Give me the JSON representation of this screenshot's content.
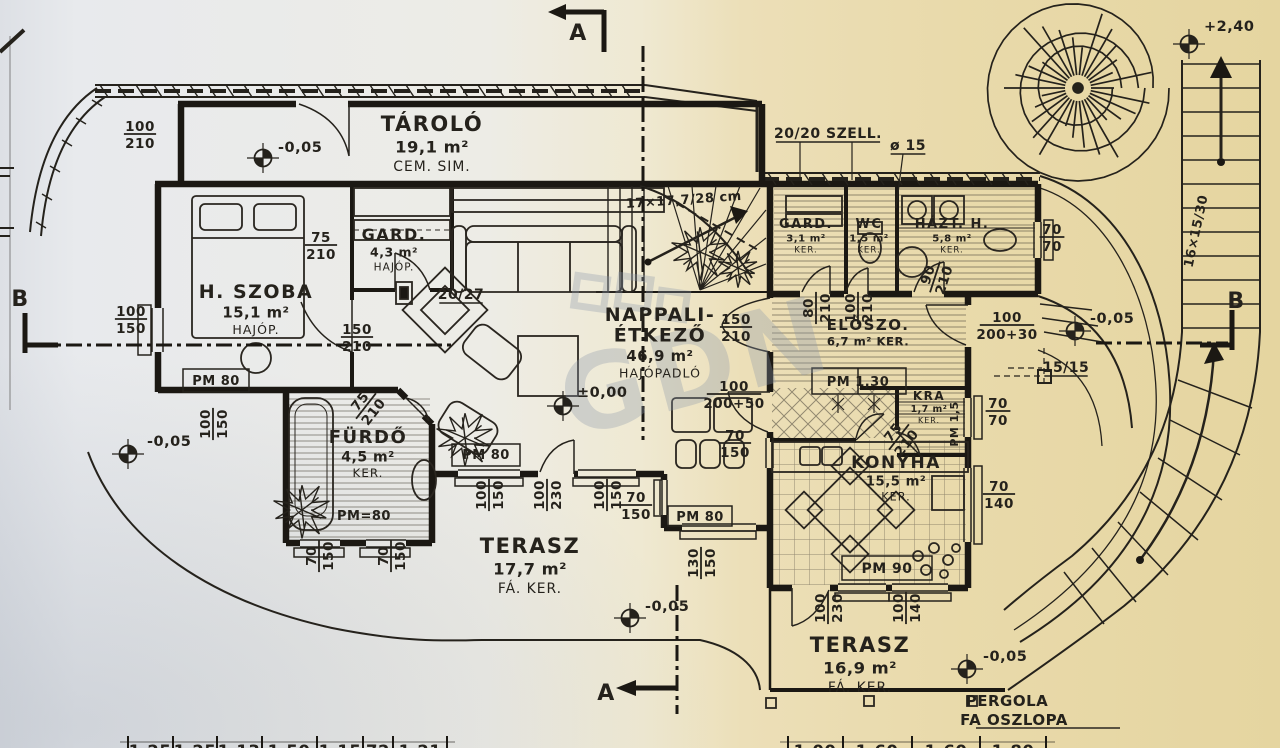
{
  "colors": {
    "ink": "#25221c",
    "paper_left": "#e7e9ec",
    "paper_right": "#e5d6a2",
    "watermark": "#8d99ab"
  },
  "watermark": {
    "text": "GDN"
  },
  "rooms": [
    {
      "name": "TÁROLÓ",
      "area": "19,1 m²",
      "floor": "CEM. SIM.",
      "x": 432,
      "y": 131,
      "fs": 21
    },
    {
      "name": "GARD.",
      "area": "4,3 m²",
      "floor": "HAJÓP.",
      "x": 394,
      "y": 240,
      "fs": 16
    },
    {
      "name": "H. SZOBA",
      "area": "15,1 m²",
      "floor": "HAJÓP.",
      "x": 256,
      "y": 298,
      "fs": 19
    },
    {
      "name": "NAPPALI-",
      "name2": "ÉTKEZŐ",
      "area": "46,9 m²",
      "floor": "HAJÓPADLÓ",
      "x": 660,
      "y": 321,
      "fs": 19
    },
    {
      "name": "FÜRDŐ",
      "area": "4,5 m²",
      "floor": "KER.",
      "x": 368,
      "y": 443,
      "fs": 18
    },
    {
      "name": "TERASZ",
      "area": "17,7 m²",
      "floor": "FÁ. KER.",
      "x": 530,
      "y": 553,
      "fs": 21
    },
    {
      "name": "GARD.",
      "area": "3,1 m²",
      "floor": "KER.",
      "x": 806,
      "y": 228,
      "fs": 13
    },
    {
      "name": "WC",
      "area": "1,5 m²",
      "floor": "KER.",
      "x": 869,
      "y": 228,
      "fs": 13
    },
    {
      "name": "HÁZT. H.",
      "area": "5,8 m²",
      "floor": "KER.",
      "x": 952,
      "y": 228,
      "fs": 13
    },
    {
      "name": "ELŐSZO.",
      "area": "6,7 m² KER.",
      "x": 868,
      "y": 330,
      "fs": 15
    },
    {
      "name": "KRA",
      "area": "1,7 m²",
      "floor": "KER.",
      "x": 929,
      "y": 400,
      "fs": 12
    },
    {
      "name": "KONYHA",
      "area": "15,5 m²",
      "floor": "KER.",
      "x": 896,
      "y": 468,
      "fs": 17
    },
    {
      "name": "TERASZ",
      "area": "16,9 m²",
      "floor": "FÁ. KER.",
      "x": 860,
      "y": 652,
      "fs": 21
    }
  ],
  "dims": [
    {
      "t": "100",
      "b": "210",
      "x": 140,
      "y": 134,
      "rot": 0
    },
    {
      "t": "75",
      "b": "210",
      "x": 321,
      "y": 245,
      "rot": 0
    },
    {
      "t": "100",
      "b": "150",
      "x": 131,
      "y": 319,
      "rot": 0
    },
    {
      "t": "100",
      "b": "150",
      "x": 213,
      "y": 424,
      "rot": -90
    },
    {
      "t": "150",
      "b": "210",
      "x": 357,
      "y": 337,
      "rot": 0
    },
    {
      "t": "150",
      "b": "210",
      "x": 736,
      "y": 327,
      "rot": 0
    },
    {
      "t": "100",
      "b": "200+50",
      "x": 734,
      "y": 394,
      "rot": 0
    },
    {
      "t": "70",
      "b": "150",
      "x": 735,
      "y": 443,
      "rot": 0
    },
    {
      "t": "100",
      "b": "150",
      "x": 489,
      "y": 495,
      "rot": -90
    },
    {
      "t": "100",
      "b": "230",
      "x": 547,
      "y": 495,
      "rot": -90
    },
    {
      "t": "100",
      "b": "150",
      "x": 607,
      "y": 495,
      "rot": -90
    },
    {
      "t": "70",
      "b": "150",
      "x": 636,
      "y": 505,
      "rot": 0
    },
    {
      "t": "130",
      "b": "150",
      "x": 701,
      "y": 563,
      "rot": -90
    },
    {
      "t": "70",
      "b": "150",
      "x": 319,
      "y": 556,
      "rot": -90
    },
    {
      "t": "70",
      "b": "150",
      "x": 391,
      "y": 556,
      "rot": -90
    },
    {
      "t": "75",
      "b": "210",
      "x": 366,
      "y": 406,
      "rot": -52
    },
    {
      "t": "75",
      "b": "210",
      "x": 899,
      "y": 437,
      "rot": -52
    },
    {
      "t": "80",
      "b": "210",
      "x": 816,
      "y": 308,
      "rot": -90
    },
    {
      "t": "100",
      "b": "210",
      "x": 858,
      "y": 308,
      "rot": -90
    },
    {
      "t": "90",
      "b": "210",
      "x": 935,
      "y": 277,
      "rot": -72
    },
    {
      "t": "70",
      "b": "70",
      "x": 1052,
      "y": 237,
      "rot": 0
    },
    {
      "t": "70",
      "b": "70",
      "x": 998,
      "y": 411,
      "rot": 0
    },
    {
      "t": "70",
      "b": "140",
      "x": 999,
      "y": 494,
      "rot": 0
    },
    {
      "t": "100",
      "b": "200+30",
      "x": 1007,
      "y": 325,
      "rot": 0
    },
    {
      "t": "100",
      "b": "230",
      "x": 828,
      "y": 608,
      "rot": -90
    },
    {
      "t": "100",
      "b": "140",
      "x": 906,
      "y": 608,
      "rot": -90
    }
  ],
  "notes": [
    {
      "t": "20/20 SZELL.",
      "x": 828,
      "y": 138,
      "fs": 14,
      "ul": true
    },
    {
      "t": "ø 15",
      "x": 908,
      "y": 150,
      "fs": 14,
      "ul": true
    },
    {
      "t": "17×17,7/28 cm",
      "x": 684,
      "y": 204,
      "fs": 13,
      "rot": -4
    },
    {
      "t": "16×15/30",
      "x": 1200,
      "y": 232,
      "fs": 13,
      "rot": -78
    },
    {
      "t": "20/27",
      "x": 461,
      "y": 299,
      "fs": 14,
      "ul": true
    },
    {
      "t": "15/15",
      "x": 1066,
      "y": 372,
      "fs": 14,
      "ul": true
    },
    {
      "t": "PERGOLA",
      "x": 1007,
      "y": 706,
      "fs": 15
    },
    {
      "t": "FA OSZLOPA",
      "x": 1014,
      "y": 725,
      "fs": 15
    },
    {
      "t": "PM 80",
      "x": 216,
      "y": 385,
      "fs": 13
    },
    {
      "t": "PM 80",
      "x": 486,
      "y": 459,
      "fs": 13
    },
    {
      "t": "PM 80",
      "x": 700,
      "y": 521,
      "fs": 13
    },
    {
      "t": "PM=80",
      "x": 364,
      "y": 520,
      "fs": 13
    },
    {
      "t": "PM 90",
      "x": 887,
      "y": 573,
      "fs": 14
    },
    {
      "t": "PM 1,30",
      "x": 858,
      "y": 386,
      "fs": 13
    },
    {
      "t": "PM 1,5",
      "x": 958,
      "y": 424,
      "fs": 11,
      "rot": -90
    }
  ],
  "levels": [
    {
      "t": "-0,05",
      "x": 278,
      "y": 152,
      "sx": 263,
      "sy": 158
    },
    {
      "t": "-0,05",
      "x": 147,
      "y": 446,
      "sx": 128,
      "sy": 454
    },
    {
      "t": "±0,00",
      "x": 577,
      "y": 397,
      "sx": 563,
      "sy": 406
    },
    {
      "t": "-0,05",
      "x": 645,
      "y": 611,
      "sx": 630,
      "sy": 618
    },
    {
      "t": "-0,05",
      "x": 983,
      "y": 661,
      "sx": 967,
      "sy": 669
    },
    {
      "t": "-0,05",
      "x": 1090,
      "y": 323,
      "sx": 1075,
      "sy": 331
    },
    {
      "t": "+2,40",
      "x": 1204,
      "y": 31,
      "sx": 1189,
      "sy": 44
    }
  ],
  "sections": [
    {
      "t": "A",
      "x": 578,
      "y": 40
    },
    {
      "t": "A",
      "x": 606,
      "y": 700
    },
    {
      "t": "B",
      "x": 20,
      "y": 306
    },
    {
      "t": "B",
      "x": 1236,
      "y": 308
    }
  ],
  "bottom": {
    "left": [
      {
        "t": "1,25",
        "x": 150
      },
      {
        "t": "1,25",
        "x": 195
      },
      {
        "t": "1,13",
        "x": 239
      },
      {
        "t": "1,50",
        "x": 289
      },
      {
        "t": "1,15",
        "x": 340
      },
      {
        "t": "72",
        "x": 378
      },
      {
        "t": "1,21",
        "x": 420
      }
    ],
    "right": [
      {
        "t": "1,00",
        "x": 815
      },
      {
        "t": "1,60",
        "x": 877
      },
      {
        "t": "1,60",
        "x": 946
      },
      {
        "t": "1,80",
        "x": 1013
      }
    ]
  }
}
